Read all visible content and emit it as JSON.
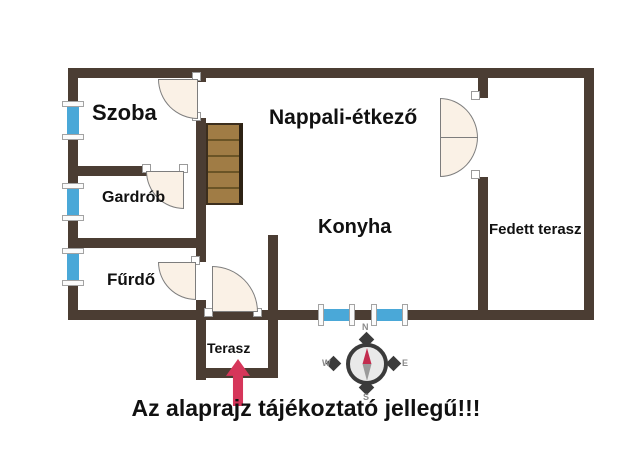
{
  "plan": {
    "rooms": [
      {
        "id": "szoba",
        "label": "Szoba"
      },
      {
        "id": "gardrob",
        "label": "Gardrób"
      },
      {
        "id": "furdo",
        "label": "Fűrdő"
      },
      {
        "id": "nappali",
        "label": "Nappali-étkező"
      },
      {
        "id": "konyha",
        "label": "Konyha"
      },
      {
        "id": "fedett_terasz",
        "label": "Fedett terasz"
      },
      {
        "id": "terasz",
        "label": "Terasz"
      }
    ],
    "disclaimer": "Az alaprajz tájékoztató jellegű!!!",
    "compass": {
      "n": "N",
      "e": "E",
      "s": "S",
      "w": "W"
    },
    "features": {
      "stair_treads": 5,
      "windows_left_wall": 3,
      "windows_bottom_wall": 2,
      "entry_arrow_direction": "up"
    },
    "colors": {
      "wall": "#4b3d33",
      "window": "#4aa8d8",
      "door_fill": "#faf1e6",
      "door_border": "#7d7d7d",
      "stairs": "#a07c45",
      "stair_line": "#6a5426",
      "arrow": "#d6365a",
      "compass_dark": "#3b3b3b",
      "compass_face": "#e9e9e9",
      "needle_north": "#c22c4e",
      "needle_south": "#9a9a9a",
      "text": "#111111"
    }
  }
}
